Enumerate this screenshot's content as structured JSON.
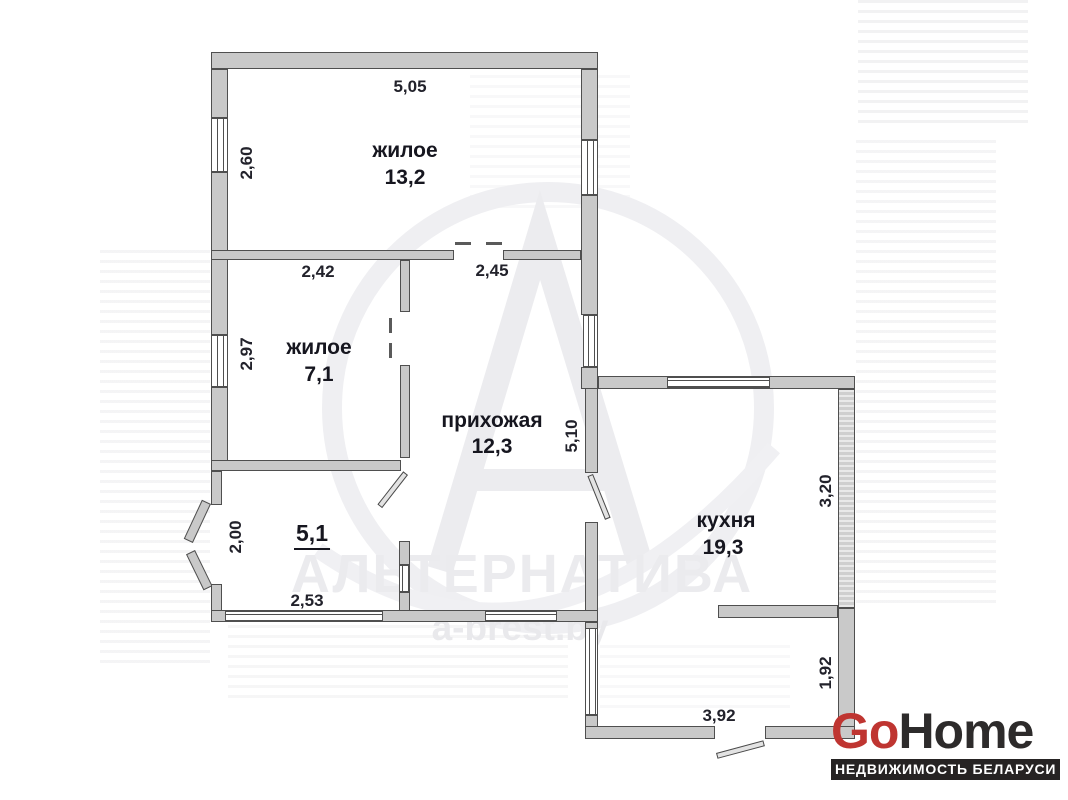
{
  "watermark": {
    "brand": "АЛЬТЕРНАТИВА",
    "site": "a-brest.by"
  },
  "logo": {
    "go": "Go",
    "home": "Home",
    "tagline": "НЕДВИЖИМОСТЬ БЕЛАРУСИ"
  },
  "colors": {
    "logo_red": "#bf3531",
    "logo_dark": "#2d2b2b",
    "wall_fill": "#c9c9c9",
    "wall_line": "#4f4f4f",
    "label_text": "#16161f",
    "watermark_gray": "#ebebee"
  },
  "rooms": {
    "living_large": {
      "label": "жилое",
      "area": "13,2"
    },
    "living_small": {
      "label": "жилое",
      "area": "7,1"
    },
    "hallway": {
      "label": "прихожая",
      "area": "12,3"
    },
    "room_5": {
      "area": "5,1"
    },
    "kitchen": {
      "label": "кухня",
      "area": "19,3"
    }
  },
  "dimensions": {
    "living_large_width": "5,05",
    "living_large_depth": "2,60",
    "living_small_width": "2,42",
    "living_small_depth": "2,97",
    "hallway_width": "2,45",
    "hallway_depth": "5,10",
    "room_5_depth": "2,00",
    "room_5_width": "2,53",
    "kitchen_depth": "3,20",
    "annex_depth": "1,92",
    "annex_width": "3,92"
  }
}
